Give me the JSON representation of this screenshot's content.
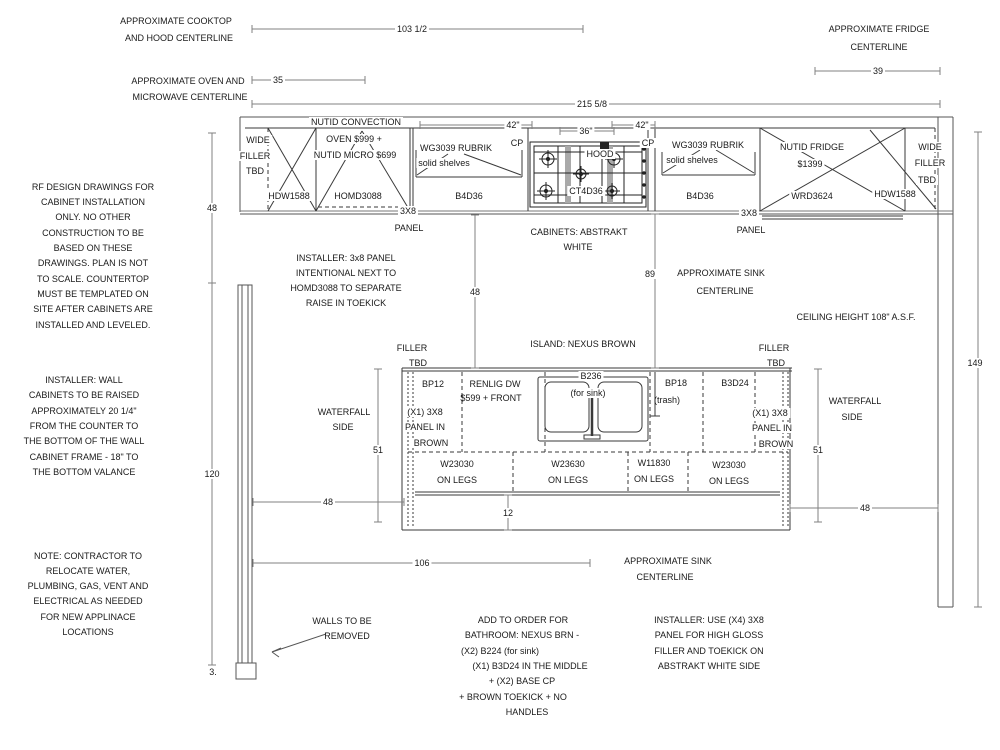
{
  "meta": {
    "drawing_type": "kitchen cabinet installation elevation drawing",
    "cabinet_finish": "ABSTRAKT WHITE",
    "island_finish": "NEXUS BROWN"
  },
  "colors": {
    "background": "#ffffff",
    "cabinet_line": "#3a3a3a",
    "wall_line": "#555555",
    "dim_line": "#808080",
    "text": "#1a1a1a"
  },
  "annotations": [
    {
      "name": "cooktop-centerline-note-1",
      "x": 176,
      "y": 21,
      "text": "APPROXIMATE COOKTOP"
    },
    {
      "name": "cooktop-centerline-note-2",
      "x": 179,
      "y": 38,
      "text": "AND HOOD CENTERLINE"
    },
    {
      "name": "oven-centerline-note-1",
      "x": 188,
      "y": 81,
      "text": "APPROXIMATE OVEN AND"
    },
    {
      "name": "oven-centerline-note-2",
      "x": 190,
      "y": 97,
      "text": "MICROWAVE CENTERLINE"
    },
    {
      "name": "fridge-centerline-note-1",
      "x": 879,
      "y": 29,
      "text": "APPROXIMATE FRIDGE"
    },
    {
      "name": "fridge-centerline-note-2",
      "x": 879,
      "y": 47,
      "text": "CENTERLINE"
    },
    {
      "name": "rf-design-note-1",
      "x": 93,
      "y": 187,
      "text": "RF DESIGN DRAWINGS FOR"
    },
    {
      "name": "rf-design-note-2",
      "x": 93,
      "y": 202,
      "text": "CABINET INSTALLATION"
    },
    {
      "name": "rf-design-note-3",
      "x": 93,
      "y": 217,
      "text": "ONLY. NO OTHER"
    },
    {
      "name": "rf-design-note-4",
      "x": 93,
      "y": 233,
      "text": "CONSTRUCTION TO BE"
    },
    {
      "name": "rf-design-note-5",
      "x": 93,
      "y": 248,
      "text": "BASED ON THESE"
    },
    {
      "name": "rf-design-note-6",
      "x": 93,
      "y": 263,
      "text": "DRAWINGS. PLAN IS NOT"
    },
    {
      "name": "rf-design-note-7",
      "x": 93,
      "y": 279,
      "text": "TO SCALE. COUNTERTOP"
    },
    {
      "name": "rf-design-note-8",
      "x": 93,
      "y": 294,
      "text": "MUST BE TEMPLATED ON"
    },
    {
      "name": "rf-design-note-9",
      "x": 93,
      "y": 309,
      "text": "SITE AFTER CABINETS ARE"
    },
    {
      "name": "rf-design-note-10",
      "x": 93,
      "y": 325,
      "text": "INSTALLED AND LEVELED."
    },
    {
      "name": "installer-wall-note-1",
      "x": 84,
      "y": 380,
      "text": "INSTALLER: WALL"
    },
    {
      "name": "installer-wall-note-2",
      "x": 84,
      "y": 395,
      "text": "CABINETS TO BE RAISED"
    },
    {
      "name": "installer-wall-note-3",
      "x": 84,
      "y": 411,
      "text": "APPROXIMATELY 20 1/4\""
    },
    {
      "name": "installer-wall-note-4",
      "x": 84,
      "y": 426,
      "text": "FROM THE COUNTER TO"
    },
    {
      "name": "installer-wall-note-5",
      "x": 84,
      "y": 441,
      "text": "THE BOTTOM OF THE WALL"
    },
    {
      "name": "installer-wall-note-6",
      "x": 84,
      "y": 457,
      "text": "CABINET FRAME - 18\" TO"
    },
    {
      "name": "installer-wall-note-7",
      "x": 84,
      "y": 472,
      "text": "THE BOTTOM VALANCE"
    },
    {
      "name": "contractor-note-1",
      "x": 88,
      "y": 556,
      "text": "NOTE: CONTRACTOR TO"
    },
    {
      "name": "contractor-note-2",
      "x": 88,
      "y": 571,
      "text": "RELOCATE WATER,"
    },
    {
      "name": "contractor-note-3",
      "x": 88,
      "y": 586,
      "text": "PLUMBING, GAS, VENT AND"
    },
    {
      "name": "contractor-note-4",
      "x": 88,
      "y": 601,
      "text": "ELECTRICAL AS NEEDED"
    },
    {
      "name": "contractor-note-5",
      "x": 88,
      "y": 617,
      "text": "FOR NEW APPLINACE"
    },
    {
      "name": "contractor-note-6",
      "x": 88,
      "y": 632,
      "text": "LOCATIONS"
    },
    {
      "name": "wide-filler-left-1",
      "x": 258,
      "y": 140,
      "text": "WIDE",
      "bg": true
    },
    {
      "name": "wide-filler-left-2",
      "x": 255,
      "y": 156,
      "text": "FILLER",
      "bg": true
    },
    {
      "name": "wide-filler-left-3",
      "x": 255,
      "y": 171,
      "text": "TBD",
      "bg": true
    },
    {
      "name": "hdw1588-left-label",
      "x": 289,
      "y": 196,
      "text": "HDW1588",
      "bg": true
    },
    {
      "name": "nutid-convection-label-1",
      "x": 356,
      "y": 122,
      "text": "NUTID CONVECTION",
      "bg": true
    },
    {
      "name": "nutid-convection-label-2",
      "x": 354,
      "y": 139,
      "text": "OVEN $999 +",
      "bg": true
    },
    {
      "name": "nutid-convection-label-3",
      "x": 355,
      "y": 155,
      "text": "NUTID MICRO $699",
      "bg": true
    },
    {
      "name": "homd3088-label",
      "x": 358,
      "y": 196,
      "text": "HOMD3088",
      "bg": true
    },
    {
      "name": "wg3039-left-label-1",
      "x": 456,
      "y": 148,
      "text": "WG3039 RUBRIK",
      "bg": true
    },
    {
      "name": "wg3039-left-label-2",
      "x": 444,
      "y": 163,
      "text": "solid shelves",
      "bg": true
    },
    {
      "name": "b4d36-left-label",
      "x": 469,
      "y": 196,
      "text": "B4D36"
    },
    {
      "name": "cp-left-label",
      "x": 517,
      "y": 143,
      "text": "CP",
      "bg": true
    },
    {
      "name": "hood-label",
      "x": 600,
      "y": 154,
      "text": "HOOD",
      "bg": true
    },
    {
      "name": "ct4d36-label",
      "x": 586,
      "y": 191,
      "text": "CT4D36",
      "bg": true
    },
    {
      "name": "cp-right-label",
      "x": 648,
      "y": 143,
      "text": "CP",
      "bg": true
    },
    {
      "name": "wg3039-right-label-1",
      "x": 708,
      "y": 145,
      "text": "WG3039 RUBRIK",
      "bg": true
    },
    {
      "name": "wg3039-right-label-2",
      "x": 692,
      "y": 160,
      "text": "solid shelves",
      "bg": true
    },
    {
      "name": "b4d36-right-label",
      "x": 700,
      "y": 196,
      "text": "B4D36"
    },
    {
      "name": "nutid-fridge-label-1",
      "x": 812,
      "y": 147,
      "text": "NUTID FRIDGE",
      "bg": true
    },
    {
      "name": "nutid-fridge-label-2",
      "x": 810,
      "y": 164,
      "text": "$1399",
      "bg": true
    },
    {
      "name": "wrd3624-label",
      "x": 812,
      "y": 196,
      "text": "WRD3624",
      "bg": true
    },
    {
      "name": "hdw1588-right-label",
      "x": 895,
      "y": 194,
      "text": "HDW1588",
      "bg": true
    },
    {
      "name": "wide-filler-right-1",
      "x": 930,
      "y": 147,
      "text": "WIDE",
      "bg": true
    },
    {
      "name": "wide-filler-right-2",
      "x": 930,
      "y": 163,
      "text": "FILLER",
      "bg": true
    },
    {
      "name": "wide-filler-right-3",
      "x": 927,
      "y": 180,
      "text": "TBD",
      "bg": true
    },
    {
      "name": "panel-3x8-left-label",
      "x": 408,
      "y": 211,
      "text": "3X8",
      "bg": true
    },
    {
      "name": "panel-left-label",
      "x": 409,
      "y": 228,
      "text": "PANEL"
    },
    {
      "name": "cabinets-finish-label-1",
      "x": 579,
      "y": 232,
      "text": "CABINETS: ABSTRAKT"
    },
    {
      "name": "cabinets-finish-label-2",
      "x": 578,
      "y": 247,
      "text": "WHITE"
    },
    {
      "name": "panel-3x8-right-label",
      "x": 749,
      "y": 213,
      "text": "3X8",
      "bg": true
    },
    {
      "name": "panel-right-label",
      "x": 751,
      "y": 230,
      "text": "PANEL"
    },
    {
      "name": "installer-panel-note-1",
      "x": 346,
      "y": 258,
      "text": "INSTALLER: 3x8 PANEL"
    },
    {
      "name": "installer-panel-note-2",
      "x": 346,
      "y": 273,
      "text": "INTENTIONAL NEXT TO"
    },
    {
      "name": "installer-panel-note-3",
      "x": 346,
      "y": 288,
      "text": "HOMD3088 TO SEPARATE"
    },
    {
      "name": "installer-panel-note-4",
      "x": 346,
      "y": 303,
      "text": "RAISE IN TOEKICK"
    },
    {
      "name": "sink-centerline-note-1",
      "x": 721,
      "y": 273,
      "text": "APPROXIMATE SINK"
    },
    {
      "name": "sink-centerline-note-2",
      "x": 725,
      "y": 291,
      "text": "CENTERLINE"
    },
    {
      "name": "ceiling-height-note",
      "x": 856,
      "y": 317,
      "text": "CEILING HEIGHT 108\" A.S.F."
    },
    {
      "name": "island-finish-label",
      "x": 583,
      "y": 344,
      "text": "ISLAND: NEXUS BROWN"
    },
    {
      "name": "filler-island-left-1",
      "x": 412,
      "y": 348,
      "text": "FILLER"
    },
    {
      "name": "filler-island-left-2",
      "x": 418,
      "y": 363,
      "text": "TBD"
    },
    {
      "name": "filler-island-right-1",
      "x": 774,
      "y": 348,
      "text": "FILLER"
    },
    {
      "name": "filler-island-right-2",
      "x": 776,
      "y": 363,
      "text": "TBD"
    },
    {
      "name": "waterfall-left-1",
      "x": 344,
      "y": 412,
      "text": "WATERFALL"
    },
    {
      "name": "waterfall-left-2",
      "x": 343,
      "y": 427,
      "text": "SIDE"
    },
    {
      "name": "waterfall-right-1",
      "x": 855,
      "y": 401,
      "text": "WATERFALL"
    },
    {
      "name": "waterfall-right-2",
      "x": 852,
      "y": 417,
      "text": "SIDE"
    },
    {
      "name": "bp12-label",
      "x": 433,
      "y": 384,
      "text": "BP12"
    },
    {
      "name": "panel-brown-left-1",
      "x": 425,
      "y": 412,
      "text": "(X1) 3X8",
      "bg": true
    },
    {
      "name": "panel-brown-left-2",
      "x": 425,
      "y": 427,
      "text": "PANEL IN",
      "bg": true
    },
    {
      "name": "panel-brown-left-3",
      "x": 431,
      "y": 443,
      "text": "BROWN",
      "bg": true
    },
    {
      "name": "renlig-label-1",
      "x": 495,
      "y": 384,
      "text": "RENLIG DW"
    },
    {
      "name": "renlig-label-2",
      "x": 491,
      "y": 398,
      "text": "$599 + FRONT"
    },
    {
      "name": "b236-label",
      "x": 591,
      "y": 376,
      "text": "B236",
      "bg": true
    },
    {
      "name": "b236-sink-label",
      "x": 588,
      "y": 393,
      "text": "(for sink)",
      "bg": true
    },
    {
      "name": "bp18-label",
      "x": 676,
      "y": 383,
      "text": "BP18"
    },
    {
      "name": "bp18-trash-label",
      "x": 667,
      "y": 400,
      "text": "(trash)"
    },
    {
      "name": "b3d24-label",
      "x": 735,
      "y": 383,
      "text": "B3D24"
    },
    {
      "name": "panel-brown-right-1",
      "x": 770,
      "y": 413,
      "text": "(X1) 3X8",
      "bg": true
    },
    {
      "name": "panel-brown-right-2",
      "x": 772,
      "y": 428,
      "text": "PANEL IN",
      "bg": true
    },
    {
      "name": "panel-brown-right-3",
      "x": 776,
      "y": 444,
      "text": "BROWN",
      "bg": true
    },
    {
      "name": "w23030-1-label",
      "x": 457,
      "y": 464,
      "text": "W23030"
    },
    {
      "name": "w23030-1-legs",
      "x": 457,
      "y": 480,
      "text": "ON LEGS"
    },
    {
      "name": "w23630-label",
      "x": 568,
      "y": 464,
      "text": "W23630"
    },
    {
      "name": "w23630-legs",
      "x": 568,
      "y": 480,
      "text": "ON LEGS"
    },
    {
      "name": "w11830-label",
      "x": 654,
      "y": 463,
      "text": "W11830"
    },
    {
      "name": "w11830-legs",
      "x": 654,
      "y": 479,
      "text": "ON LEGS"
    },
    {
      "name": "w23030-2-label",
      "x": 729,
      "y": 465,
      "text": "W23030"
    },
    {
      "name": "w23030-2-legs",
      "x": 729,
      "y": 481,
      "text": "ON LEGS"
    },
    {
      "name": "sink-centerline-note-b1",
      "x": 668,
      "y": 561,
      "text": "APPROXIMATE SINK"
    },
    {
      "name": "sink-centerline-note-b2",
      "x": 665,
      "y": 577,
      "text": "CENTERLINE"
    },
    {
      "name": "walls-removed-note-1",
      "x": 342,
      "y": 621,
      "text": "WALLS TO BE"
    },
    {
      "name": "walls-removed-note-2",
      "x": 347,
      "y": 636,
      "text": "REMOVED"
    },
    {
      "name": "add-order-note-1",
      "x": 523,
      "y": 620,
      "text": "ADD TO ORDER FOR"
    },
    {
      "name": "add-order-note-2",
      "x": 522,
      "y": 635,
      "text": "BATHROOM: NEXUS BRN -"
    },
    {
      "name": "add-order-note-3",
      "x": 500,
      "y": 651,
      "text": "(X2) B224 (for sink)"
    },
    {
      "name": "add-order-note-4",
      "x": 530,
      "y": 666,
      "text": "(X1) B3D24 IN THE MIDDLE"
    },
    {
      "name": "add-order-note-5",
      "x": 522,
      "y": 681,
      "text": "+ (X2) BASE CP"
    },
    {
      "name": "add-order-note-6",
      "x": 513,
      "y": 697,
      "text": "+ BROWN TOEKICK + NO"
    },
    {
      "name": "add-order-note-7",
      "x": 527,
      "y": 712,
      "text": "HANDLES"
    },
    {
      "name": "installer-use-note-1",
      "x": 709,
      "y": 620,
      "text": "INSTALLER: USE (X4) 3X8"
    },
    {
      "name": "installer-use-note-2",
      "x": 709,
      "y": 635,
      "text": "PANEL FOR HIGH GLOSS"
    },
    {
      "name": "installer-use-note-3",
      "x": 709,
      "y": 651,
      "text": "FILLER AND TOEKICK ON"
    },
    {
      "name": "installer-use-note-4",
      "x": 709,
      "y": 666,
      "text": "ABSTRAKT WHITE SIDE"
    },
    {
      "name": "wall-foot-dim",
      "x": 213,
      "y": 672,
      "text": "3."
    }
  ],
  "dimensions": [
    {
      "name": "dim-cooktop-hood-centerline",
      "value": "103 1/2",
      "o": "h",
      "x1": 252,
      "x2": 583,
      "y": 29,
      "lx": 412
    },
    {
      "name": "dim-oven-micro-centerline",
      "value": "35",
      "o": "h",
      "x1": 252,
      "x2": 365,
      "y": 80,
      "lx": 278
    },
    {
      "name": "dim-overall-width",
      "value": "215 5/8",
      "o": "h",
      "x1": 252,
      "x2": 940,
      "y": 104,
      "lx": 592
    },
    {
      "name": "dim-fridge-centerline",
      "value": "39",
      "o": "h",
      "x1": 815,
      "x2": 940,
      "y": 71,
      "lx": 878
    },
    {
      "name": "dim-upper-wall-height",
      "value": "48",
      "o": "v",
      "x": 212,
      "y1": 133,
      "y2": 283
    },
    {
      "name": "dim-lower-wall-height",
      "value": "120",
      "o": "v",
      "x": 212,
      "y1": 283,
      "y2": 665
    },
    {
      "name": "dim-counter-island-gap",
      "value": "48",
      "o": "v",
      "x": 475,
      "y1": 215,
      "y2": 368
    },
    {
      "name": "dim-sink-centerline-v",
      "value": "89",
      "o": "v",
      "x": 655,
      "y1": 214,
      "y2": 368,
      "lx": 650,
      "ly": 274
    },
    {
      "name": "dim-island-left-height",
      "value": "51",
      "o": "v",
      "x": 378,
      "y1": 369,
      "y2": 522,
      "ly": 450
    },
    {
      "name": "dim-island-right-height",
      "value": "51",
      "o": "v",
      "x": 818,
      "y1": 369,
      "y2": 522,
      "ly": 450
    },
    {
      "name": "dim-left-aisle",
      "value": "48",
      "o": "h",
      "x1": 253,
      "x2": 404,
      "y": 502,
      "lx": 328
    },
    {
      "name": "dim-right-aisle",
      "value": "48",
      "o": "h",
      "x1": 790,
      "x2": 938,
      "y": 508,
      "lx": 865
    },
    {
      "name": "dim-island-toekick",
      "value": "12",
      "o": "v",
      "x": 508,
      "y1": 495,
      "y2": 530,
      "ly": 513
    },
    {
      "name": "dim-sink-centerline-h",
      "value": "106",
      "o": "h",
      "x1": 253,
      "x2": 590,
      "y": 563,
      "lx": 422
    },
    {
      "name": "dim-right-wall-height",
      "value": "149",
      "o": "v",
      "x": 978,
      "y1": 132,
      "y2": 607,
      "lx": 975,
      "ly": 363
    },
    {
      "name": "dim-hood-width",
      "value": "36\"",
      "o": "h",
      "x1": 560,
      "x2": 614,
      "y": 131,
      "lx": 586
    },
    {
      "name": "dim-left-wall-cab-height",
      "value": "42\"",
      "o": "h",
      "x1": 420,
      "x2": 532,
      "y": 125,
      "lx": 513
    },
    {
      "name": "dim-right-wall-cab-height",
      "value": "42\"",
      "o": "h",
      "x1": 612,
      "x2": 655,
      "y": 125,
      "lx": 642
    }
  ]
}
